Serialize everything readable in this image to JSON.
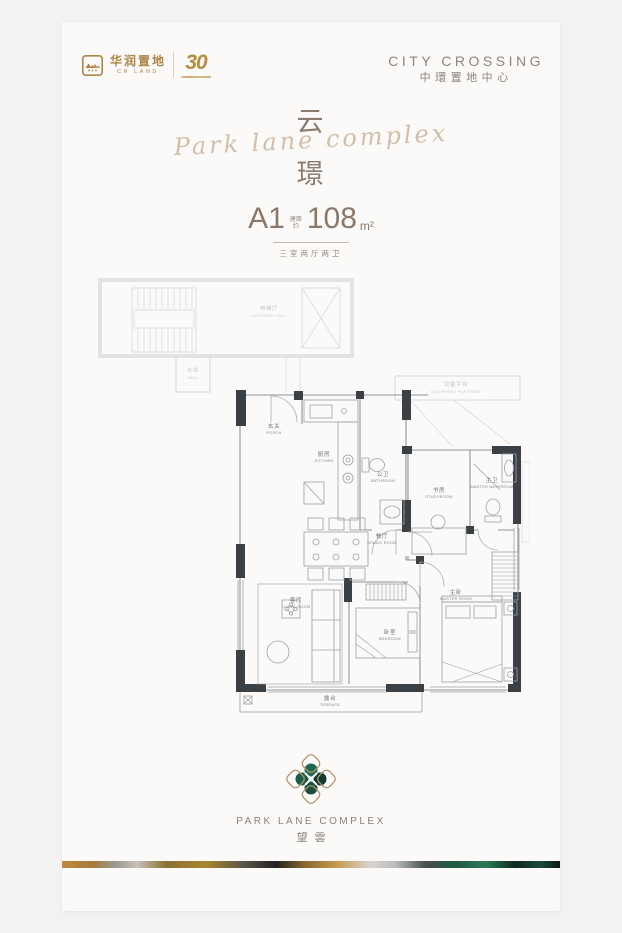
{
  "header": {
    "brand": {
      "logo_zh": "华润置地",
      "logo_en": "CR LAND",
      "anniversary": "30"
    },
    "project": {
      "name_en": "CITY CROSSING",
      "name_zh": "中環置地中心"
    }
  },
  "hero": {
    "script": "Park lane complex",
    "char_top": "云",
    "char_bottom": "璟"
  },
  "unit": {
    "code": "A1",
    "area_label_top": "建面",
    "area_label_bottom": "约",
    "area_value": "108",
    "area_unit": "m²",
    "layout_desc": "三室两厅两卫"
  },
  "floorplan": {
    "rooms": [
      {
        "zh": "电梯厅",
        "en": "ELEVATOR HALL"
      },
      {
        "zh": "水井",
        "en": "WELL"
      },
      {
        "zh": "设备平台",
        "en": "EQUIPMENT PLATFORM"
      },
      {
        "zh": "玄关",
        "en": "PORCH"
      },
      {
        "zh": "厨房",
        "en": "KITCHEN"
      },
      {
        "zh": "公卫",
        "en": "BATHROOM"
      },
      {
        "zh": "书房",
        "en": "STUDYROOM"
      },
      {
        "zh": "主卫",
        "en": "MASTER BATHROOM"
      },
      {
        "zh": "餐厅",
        "en": "DINING ROOM"
      },
      {
        "zh": "主卧",
        "en": "MASTER ROOM"
      },
      {
        "zh": "客厅",
        "en": "LIVING ROOM"
      },
      {
        "zh": "卧室",
        "en": "BEDROOM"
      },
      {
        "zh": "露台",
        "en": "TERRACE"
      }
    ]
  },
  "footer": {
    "brand_en": "PARK LANE COMPLEX",
    "brand_zh": "望雲"
  },
  "colors": {
    "accent_gold": "#b08947",
    "title_brown": "#8c7b6e",
    "script_tan": "#c9b093",
    "spec_brown": "#8b7868",
    "plan_wall_dark": "#3b4044",
    "plan_line": "#8d969c",
    "plan_faint": "#e2e1df",
    "emblem_green_dark": "#123a2d",
    "emblem_green": "#1d6a50",
    "strip_gold": "#c08a3e",
    "strip_black": "#23211e",
    "strip_malachite": "#1c5a41"
  }
}
